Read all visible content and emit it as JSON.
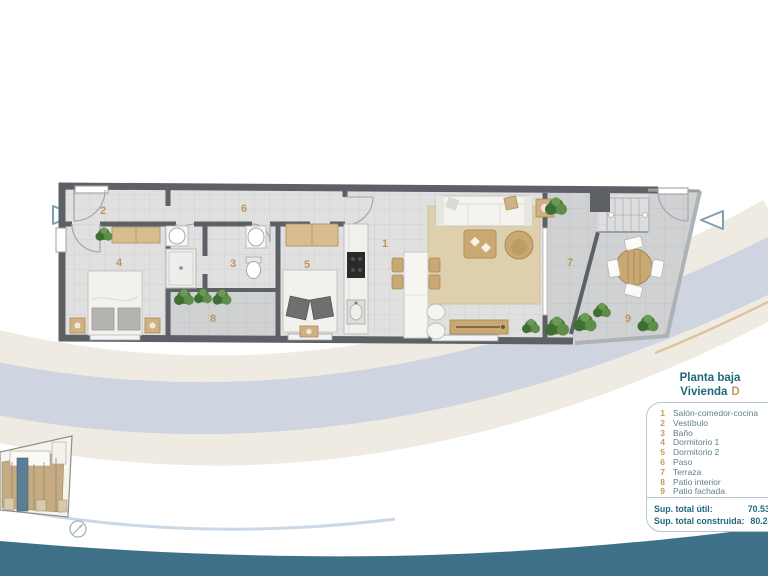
{
  "legend": {
    "title_floor": "Planta baja",
    "title_unit": "Vivienda",
    "unit_letter": "D",
    "rooms": [
      {
        "num": "1",
        "name": "Salón-comedor-cocina"
      },
      {
        "num": "2",
        "name": "Vestíbulo"
      },
      {
        "num": "3",
        "name": "Baño"
      },
      {
        "num": "4",
        "name": "Dormitorio 1"
      },
      {
        "num": "5",
        "name": "Dormitorio 2"
      },
      {
        "num": "6",
        "name": "Paso"
      },
      {
        "num": "7",
        "name": "Terraza"
      },
      {
        "num": "8",
        "name": "Patio interior"
      },
      {
        "num": "9",
        "name": "Patio fachada"
      }
    ]
  },
  "totals": {
    "util_label": "Sup. total útil:",
    "util_value": "70.53 m²",
    "built_label": "Sup. total construida:",
    "built_value": "80.24 m²"
  },
  "icons": {
    "entry_arrow_left": "triangle-right-outline",
    "entry_arrow_right": "triangle-left-outline",
    "compass": "circle-needle"
  },
  "colors": {
    "teal_text": "#20687e",
    "tan_accent": "#c49a5f",
    "wave_teal": "#3e7187",
    "band_blue": "#cbd3df",
    "band_beige": "#eae4d8",
    "wall": "#5d6165",
    "highlight_unit": "#5b7e95"
  }
}
